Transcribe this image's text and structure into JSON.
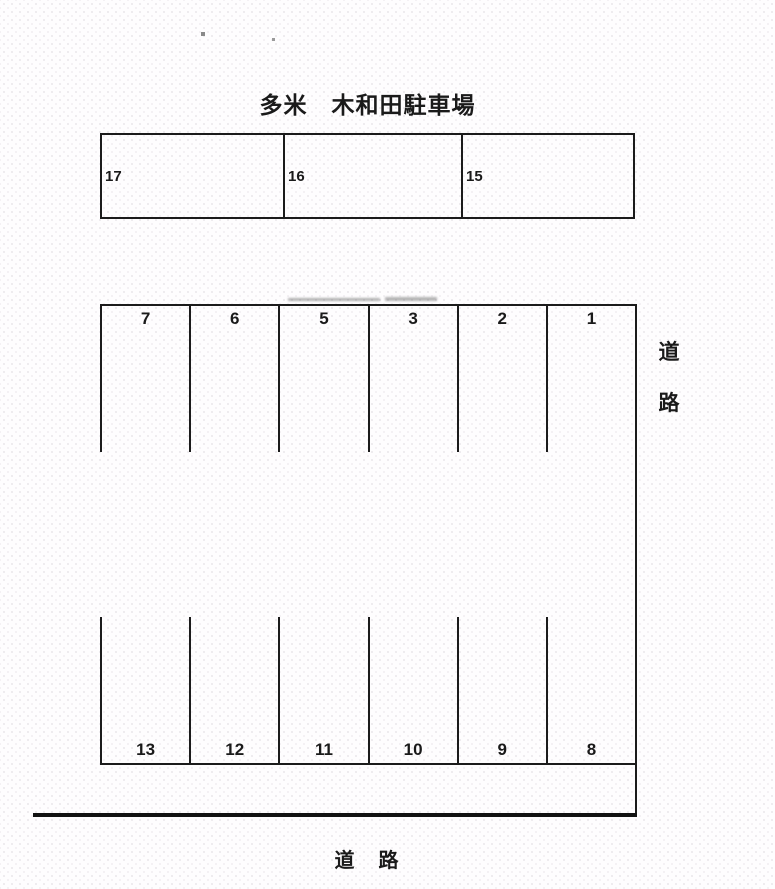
{
  "title": "多米　木和田駐車場",
  "upper_block": {
    "stalls": [
      "17",
      "16",
      "15"
    ]
  },
  "main_lot": {
    "top_row": [
      "7",
      "6",
      "5",
      "3",
      "2",
      "1"
    ],
    "bottom_row": [
      "13",
      "12",
      "11",
      "10",
      "9",
      "8"
    ]
  },
  "labels": {
    "road_right_chars": [
      "道",
      "路"
    ],
    "road_bottom": "道　路"
  },
  "colors": {
    "line": "#1b1b1b",
    "background": "#fefdfe"
  }
}
